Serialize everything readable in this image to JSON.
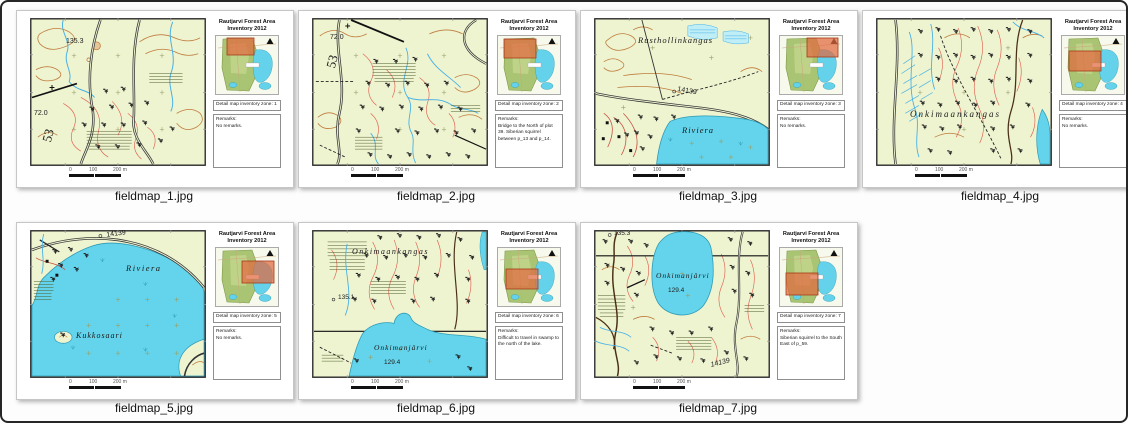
{
  "shared": {
    "title_line1": "Rautjarvi Forest Area",
    "title_line2": "Inventory 2012",
    "remarks_label": "Remarks:",
    "scalebar": {
      "t0": "0",
      "t1": "100",
      "t2": "200 m"
    },
    "colors": {
      "map_background": "#eef3d0",
      "lake": "#63d4ec",
      "contour": "#bf7c3c",
      "detail_line": "#e0604e",
      "stream": "#45b0e6",
      "overview_highlight": "#e2683f"
    }
  },
  "cards": [
    {
      "filename": "fieldmap_1.jpg",
      "zone_label": "Detail map inventory zone: 1",
      "remarks": "No remarks.",
      "labels": {
        "a": "135.3",
        "b": "72.0",
        "c": "53"
      }
    },
    {
      "filename": "fieldmap_2.jpg",
      "zone_label": "Detail map inventory zone: 2",
      "remarks": "Bridge to the North of plot 39. Siberian squirrel between p_13 and p_14.",
      "labels": {
        "a": "72.0",
        "b": "53"
      }
    },
    {
      "filename": "fieldmap_3.jpg",
      "zone_label": "Detail map inventory zone: 3",
      "remarks": "No remarks.",
      "labels": {
        "a": "Rusthollinkangas",
        "b": "14139",
        "c": "Riviera"
      }
    },
    {
      "filename": "fieldmap_4.jpg",
      "zone_label": "Detail map inventory zone: 4",
      "remarks": "No remarks.",
      "labels": {
        "a": "Onkimaankangas"
      }
    },
    {
      "filename": "fieldmap_5.jpg",
      "zone_label": "Detail map inventory zone: 5",
      "remarks": "No remarks.",
      "labels": {
        "a": "14139",
        "b": "Riviera",
        "c": "Kukkosaari"
      }
    },
    {
      "filename": "fieldmap_6.jpg",
      "zone_label": "Detail map inventory zone: 6",
      "remarks": "Difficult to travel in swamp to the north of the lake.",
      "labels": {
        "a": "Onkimaankangas",
        "b": "135.1",
        "c": "Onkimanjärvi",
        "d": "129.4"
      }
    },
    {
      "filename": "fieldmap_7.jpg",
      "zone_label": "Detail map inventory zone: 7",
      "remarks": "Siberian squirrel to the South East of p_59.",
      "labels": {
        "a": "135.3",
        "b": "Onkimanjärvi",
        "c": "129.4",
        "d": "14139"
      }
    }
  ]
}
